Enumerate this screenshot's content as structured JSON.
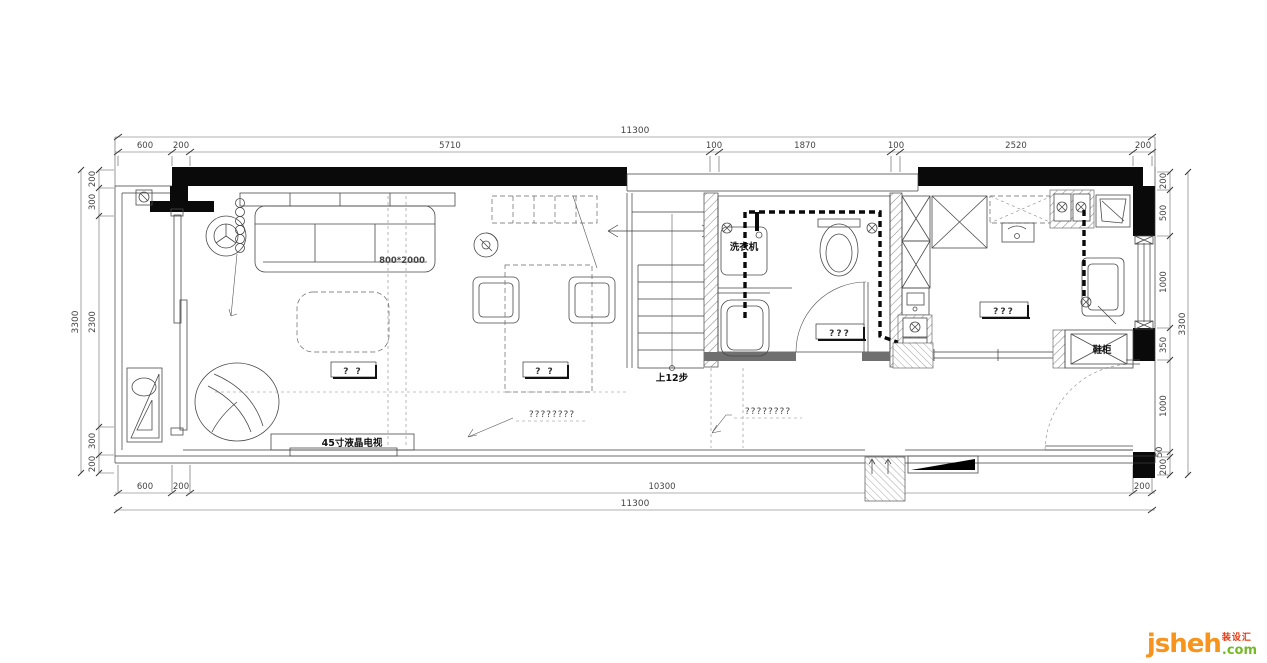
{
  "plan": {
    "labels": {
      "sofa_size": "800*2000",
      "washing_machine": "洗衣机",
      "stairs_up": "上12步",
      "tv": "45寸液晶电视",
      "shoe_cabinet": "鞋柜",
      "living_table": "? ?",
      "dining_table": "? ?",
      "bath_note": "???",
      "kitchen_note": "???",
      "floor_note_a": "????????",
      "floor_note_b": "????????"
    },
    "dims": {
      "top_total": "11300",
      "top": [
        "600",
        "200",
        "5710",
        "100",
        "1870",
        "100",
        "2520",
        "200"
      ],
      "left_total": "3300",
      "left": [
        "200",
        "300",
        "2300",
        "300",
        "200"
      ],
      "right_total": "3300",
      "right": [
        "200",
        "500",
        "1000",
        "350",
        "1000",
        "50",
        "200"
      ],
      "bottom": [
        "600",
        "200",
        "10300",
        "200"
      ],
      "bottom_total": "11300"
    }
  },
  "logo": {
    "name": "jsheh",
    "tld": ".com",
    "tag": "装设汇",
    "orange": "#F7941E",
    "green": "#76B82A",
    "red": "#E8380D"
  }
}
